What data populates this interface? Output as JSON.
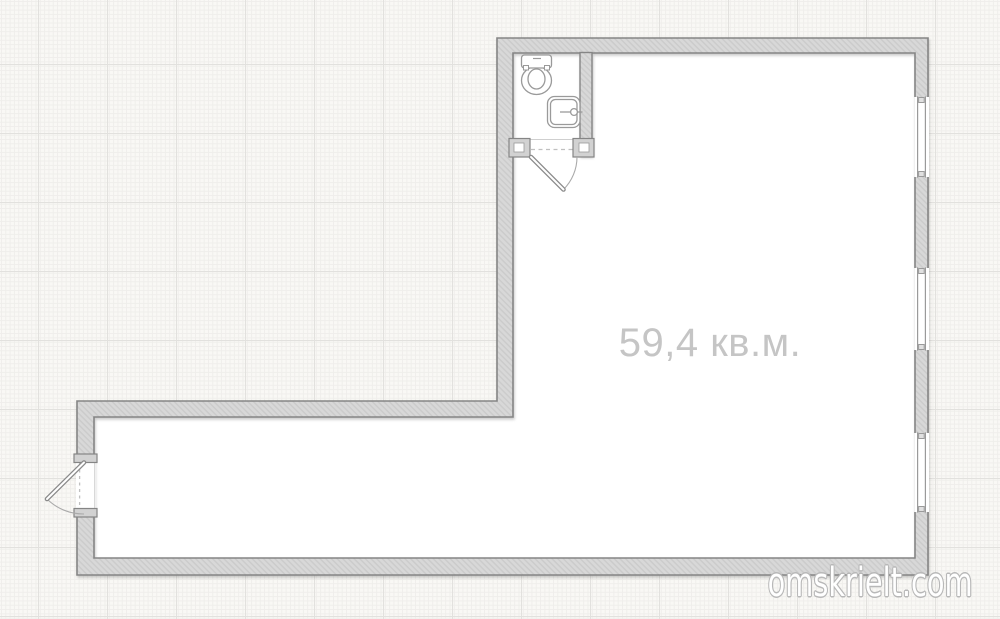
{
  "plan": {
    "area_label": "59,4 кв.м.",
    "watermark": "omskrielt.com",
    "rooms": [
      {
        "id": "main-room",
        "label": "59,4 кв.м."
      },
      {
        "id": "bathroom",
        "fixtures": [
          "toilet",
          "sink"
        ]
      }
    ],
    "window_count": 3,
    "door_count": 2,
    "colors": {
      "background": "#f9f8f5",
      "grid_minor": "#efeeeb",
      "grid_major": "#e2e1de",
      "wall_fill": "#d8d8d8",
      "wall_hatch": "#cbcbcb",
      "wall_outline": "#858585",
      "fixture_outline": "#9a9a9a",
      "area_text": "#c5c5c5",
      "watermark_fill": "#ffffff",
      "watermark_outline": "#b8b8b8"
    }
  }
}
